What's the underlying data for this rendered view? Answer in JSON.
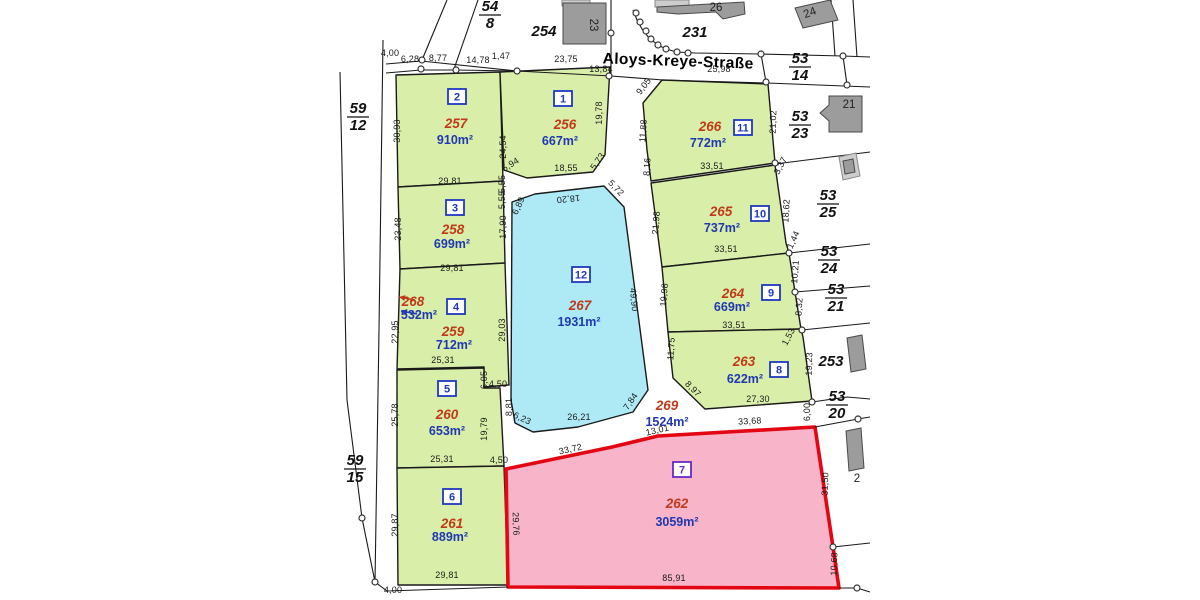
{
  "map": {
    "street": {
      "name": "Aloys-Kreye-Straße",
      "x": 678,
      "y": 66,
      "rot": 2
    },
    "colors": {
      "green": "#d9efa9",
      "cyan": "#aeeaf6",
      "pink": "#f8b4c9",
      "red_border": "#e30613",
      "parcel_number_red": "#c03a1a",
      "area_blue": "#2038b0",
      "badge_blue": "#2038c0",
      "badge_purple": "#6a28c8",
      "building_dark": "#9c9c9c",
      "building_light": "#cdcdcd",
      "line": "#1a1a1a"
    },
    "parcels": [
      {
        "id": "257",
        "area": "910m²",
        "badge": "2",
        "fill": "green",
        "pts": "396,75 500,72 503,181 398,187",
        "np": [
          456,
          128
        ],
        "ap": [
          455,
          144
        ],
        "bp": [
          457,
          97
        ]
      },
      {
        "id": "256",
        "area": "667m²",
        "badge": "1",
        "fill": "green",
        "pts": "500,72 610,67 605,155 593,172 527,178 504,170",
        "np": [
          565,
          129
        ],
        "ap": [
          560,
          145
        ],
        "bp": [
          563,
          99
        ]
      },
      {
        "id": "266",
        "area": "772m²",
        "badge": "11",
        "fill": "green",
        "pts": "662,80 768,84 775,163 651,181 647,150 643,103",
        "np": [
          710,
          131
        ],
        "ap": [
          708,
          147
        ],
        "bp": [
          743,
          128
        ]
      },
      {
        "id": "258",
        "area": "699m²",
        "badge": "3",
        "fill": "green",
        "pts": "398,187 503,181 505,263 400,269",
        "np": [
          453,
          234
        ],
        "ap": [
          452,
          248
        ],
        "bp": [
          455,
          208
        ]
      },
      {
        "id": "265",
        "area": "737m²",
        "badge": "10",
        "fill": "green",
        "pts": "651,183 775,165 786,243 789,253 662,267",
        "np": [
          721,
          216
        ],
        "ap": [
          722,
          232
        ],
        "bp": [
          760,
          214
        ]
      },
      {
        "id": "259",
        "area": "712m²",
        "badge": "4",
        "fill": "green",
        "pts": "400,269 505,263 509,385 484,387 484,367 397,369",
        "np": [
          453,
          336
        ],
        "ap": [
          454,
          349
        ],
        "bp": [
          456,
          307
        ]
      },
      {
        "id": "264",
        "area": "669m²",
        "badge": "9",
        "fill": "green",
        "pts": "662,267 789,253 795,292 801,329 668,332",
        "np": [
          733,
          298
        ],
        "ap": [
          732,
          311
        ],
        "bp": [
          771,
          293
        ]
      },
      {
        "id": "267",
        "area": "1931m²",
        "badge": "12",
        "fill": "cyan",
        "pts": "512,202 535,194 604,186 624,207 648,390 633,412 578,427 533,432 515,423 511,400",
        "np": [
          580,
          310
        ],
        "ap": [
          579,
          326
        ],
        "bp": [
          581,
          275
        ]
      },
      {
        "id": "263",
        "area": "622m²",
        "badge": "8",
        "fill": "green",
        "pts": "668,332 801,329 803,337 812,401 705,409 673,378",
        "np": [
          744,
          366
        ],
        "ap": [
          745,
          383
        ],
        "bp": [
          779,
          370
        ]
      },
      {
        "id": "260",
        "area": "653m²",
        "badge": "5",
        "fill": "green",
        "pts": "397,370 484,368 484,388 500,388 504,466 397,468",
        "np": [
          447,
          419
        ],
        "ap": [
          447,
          435
        ],
        "bp": [
          447,
          389
        ]
      },
      {
        "id": "261",
        "area": "889m²",
        "badge": "6",
        "fill": "green",
        "pts": "397,468 504,466 508,585 398,585",
        "np": [
          452,
          528
        ],
        "ap": [
          450,
          541
        ],
        "bp": [
          452,
          497
        ]
      },
      {
        "id": "262",
        "area": "3059m²",
        "badge": "7",
        "fill": "pink",
        "badge_color": "purple",
        "pts": "506,469 612,447 658,436 815,427 833,547 839,588 508,587",
        "np": [
          677,
          508
        ],
        "ap": [
          677,
          526
        ],
        "bp": [
          682,
          470
        ]
      },
      {
        "id": "268",
        "area": "532m²",
        "pts": "",
        "np": [
          413,
          306
        ],
        "ap": [
          419,
          319
        ]
      },
      {
        "id": "269",
        "area": "1524m²",
        "pts": "",
        "np": [
          667,
          410
        ],
        "ap": [
          667,
          426
        ]
      }
    ],
    "dims": [
      [
        "4,00",
        390,
        56,
        0
      ],
      [
        "6,28",
        410,
        62,
        0
      ],
      [
        "8,77",
        438,
        61,
        0
      ],
      [
        "14,78",
        478,
        63,
        0
      ],
      [
        "1,47",
        501,
        59,
        0
      ],
      [
        "23,75",
        566,
        62,
        0
      ],
      [
        "13,84",
        601,
        72,
        0
      ],
      [
        "25,98",
        719,
        72,
        0
      ],
      [
        "9,05",
        646,
        88,
        -52
      ],
      [
        "30,93",
        400,
        131,
        -90
      ],
      [
        "24,54",
        506,
        147,
        -90
      ],
      [
        "29,81",
        450,
        184,
        0
      ],
      [
        "19,78",
        602,
        113,
        -90
      ],
      [
        "5,94",
        512,
        167,
        -32
      ],
      [
        "18,55",
        566,
        171,
        0
      ],
      [
        "5,73",
        600,
        163,
        -55
      ],
      [
        "11,88",
        646,
        131,
        -86
      ],
      [
        "8,16",
        650,
        167,
        -86
      ],
      [
        "33,51",
        712,
        169,
        0
      ],
      [
        "21,02",
        776,
        122,
        -88
      ],
      [
        "3,37",
        783,
        167,
        -62
      ],
      [
        "23,48",
        401,
        229,
        -90
      ],
      [
        "17,90",
        506,
        227,
        -90
      ],
      [
        "29,81",
        452,
        271,
        0
      ],
      [
        "21,98",
        659,
        223,
        -86
      ],
      [
        "18,62",
        789,
        211,
        -87
      ],
      [
        "33,51",
        726,
        252,
        0
      ],
      [
        "1,44",
        796,
        241,
        -65
      ],
      [
        "22,95",
        398,
        332,
        -90
      ],
      [
        "29,03",
        505,
        330,
        -90
      ],
      [
        "25,31",
        443,
        363,
        0
      ],
      [
        "19,98",
        667,
        295,
        -86
      ],
      [
        "10,21",
        798,
        272,
        -86
      ],
      [
        "8,32",
        802,
        307,
        -86
      ],
      [
        "33,51",
        734,
        328,
        0
      ],
      [
        "5,55",
        505,
        184,
        -90
      ],
      [
        "5,55",
        505,
        200,
        -90
      ],
      [
        "6,89",
        521,
        207,
        -65
      ],
      [
        "18,20",
        568,
        196,
        174
      ],
      [
        "5,72",
        614,
        190,
        46
      ],
      [
        "49,90",
        631,
        300,
        85
      ],
      [
        "8,81",
        512,
        407,
        -90
      ],
      [
        "6,23",
        521,
        421,
        25
      ],
      [
        "26,21",
        579,
        420,
        0
      ],
      [
        "7,84",
        633,
        403,
        -56
      ],
      [
        "11,75",
        674,
        349,
        -86
      ],
      [
        "1,53",
        791,
        338,
        -62
      ],
      [
        "19,23",
        812,
        364,
        -88
      ],
      [
        "27,30",
        758,
        402,
        0
      ],
      [
        "8,97",
        691,
        391,
        45
      ],
      [
        "25,78",
        398,
        415,
        -90
      ],
      [
        "6,05",
        487,
        380,
        -90
      ],
      [
        "19,79",
        487,
        429,
        -90
      ],
      [
        "25,31",
        442,
        462,
        0
      ],
      [
        "4,50",
        498,
        387,
        0
      ],
      [
        "4,50",
        499,
        463,
        0
      ],
      [
        "13,01",
        658,
        433,
        -13
      ],
      [
        "33,72",
        571,
        452,
        -12
      ],
      [
        "33,68",
        750,
        424,
        -3
      ],
      [
        "29,87",
        398,
        525,
        -90
      ],
      [
        "29,81",
        447,
        578,
        0
      ],
      [
        "29,76",
        513,
        524,
        88
      ],
      [
        "31,50",
        828,
        484,
        -88
      ],
      [
        "10,68",
        837,
        564,
        -88
      ],
      [
        "85,91",
        674,
        581,
        0
      ],
      [
        "6,00",
        810,
        412,
        -90
      ],
      [
        "4,00",
        393,
        593,
        0
      ]
    ],
    "fractions": [
      [
        "54",
        "8",
        490,
        14
      ],
      [
        "53",
        "14",
        800,
        66
      ],
      [
        "53",
        "23",
        800,
        124
      ],
      [
        "53",
        "25",
        828,
        203
      ],
      [
        "53",
        "24",
        829,
        259
      ],
      [
        "53",
        "21",
        836,
        297
      ],
      [
        "53",
        "20",
        837,
        404
      ],
      [
        "59",
        "12",
        358,
        116
      ],
      [
        "59",
        "15",
        355,
        468
      ]
    ],
    "plains": [
      [
        "254",
        544,
        36
      ],
      [
        "231",
        695,
        37
      ],
      [
        "253",
        831,
        366
      ]
    ],
    "house_numbers": [
      [
        "23",
        590,
        25,
        90
      ],
      [
        "26",
        716,
        11,
        0
      ],
      [
        "24",
        811,
        16,
        -20
      ],
      [
        "21",
        849,
        108,
        0
      ],
      [
        "2",
        857,
        482,
        0
      ]
    ],
    "lines": [
      "386,73 421,70 456,70 517,71 611,76 663,80 767,83 870,87",
      "386,64 421,61 517,71",
      "447,0 422,60",
      "478,0 454,69",
      "611,0 611,76",
      "633,10 637,20 642,29 649,38 658,45 666,49 677,52 695,53 761,54",
      "761,54 843,56 870,57",
      "761,54 766,82",
      "843,56 847,85",
      "831,0 835,56",
      "853,0 857,57",
      "775,164 870,152",
      "789,253 870,244",
      "795,292 870,286",
      "802,330 870,323",
      "812,402 847,397 870,399",
      "815,427 858,419 870,417",
      "833,547 870,543",
      "839,588 857,588 870,592",
      "383,40 379,330 375,582",
      "340,72 347,400 362,518 375,582",
      "375,582 387,591 508,587"
    ],
    "buildings": [
      {
        "pts": "655,0 689,0 689,7 655,7",
        "f": "light"
      },
      {
        "pts": "562,0 590,0 590,6 562,6",
        "f": "light"
      },
      {
        "pts": "563,3 606,3 606,44 563,44",
        "f": "dark"
      },
      {
        "pts": "657,7 744,2 745,14 723,19 716,12 678,14 657,12",
        "f": "dark"
      },
      {
        "pts": "795,8 830,0 838,20 803,28",
        "f": "dark"
      },
      {
        "pts": "829,96 862,96 862,132 829,132 829,121 820,113 829,105",
        "f": "dark"
      },
      {
        "pts": "839,157 856,153 860,176 843,180",
        "f": "light"
      },
      {
        "pts": "843,161 853,159 855,172 845,174",
        "f": "dark"
      },
      {
        "pts": "847,338 862,335 866,369 851,372",
        "f": "dark"
      },
      {
        "pts": "846,431 861,428 864,468 849,471",
        "f": "dark"
      }
    ],
    "survey_points": [
      [
        422,
        60
      ],
      [
        421,
        69
      ],
      [
        456,
        70
      ],
      [
        517,
        71
      ],
      [
        611,
        33
      ],
      [
        609,
        76
      ],
      [
        636,
        13
      ],
      [
        640,
        22
      ],
      [
        646,
        31
      ],
      [
        651,
        39
      ],
      [
        658,
        45
      ],
      [
        666,
        49
      ],
      [
        677,
        52
      ],
      [
        688,
        53
      ],
      [
        761,
        54
      ],
      [
        766,
        82
      ],
      [
        843,
        56
      ],
      [
        847,
        85
      ],
      [
        775,
        163
      ],
      [
        789,
        253
      ],
      [
        795,
        292
      ],
      [
        802,
        330
      ],
      [
        812,
        402
      ],
      [
        858,
        419
      ],
      [
        833,
        547
      ],
      [
        857,
        588
      ],
      [
        362,
        518
      ],
      [
        375,
        582
      ]
    ],
    "arrows": [
      {
        "color": "parcel_number_red",
        "x1": 415,
        "y1": 300,
        "x2": 399,
        "y2": 297
      },
      {
        "color": "area_blue",
        "x1": 417,
        "y1": 314,
        "x2": 401,
        "y2": 311
      }
    ]
  }
}
